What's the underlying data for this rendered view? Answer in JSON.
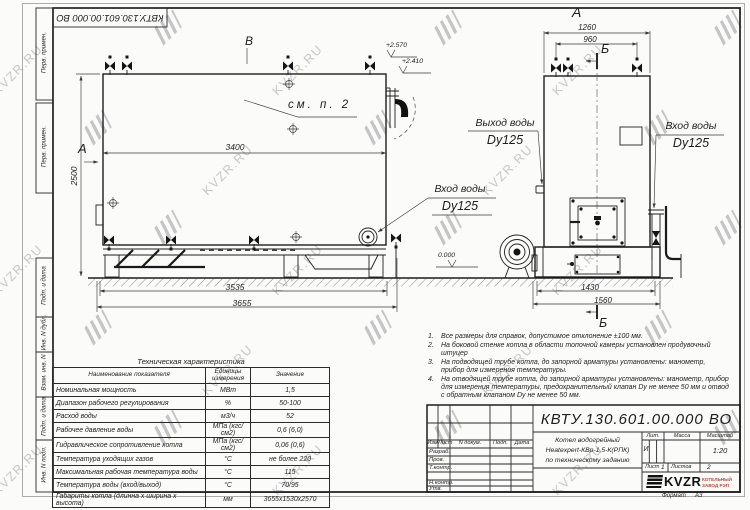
{
  "watermark": {
    "text": "KVZR.RU"
  },
  "doc_number": "КВТУ.130.601.00.000  ВО",
  "margin_fields": [
    "Перв. примен.",
    "Перв. примен.",
    "Подп. и дата",
    "Инв. N дубл.",
    "Взам. инв. N",
    "Подп. и дата",
    "Инв. N подл."
  ],
  "main_view": {
    "letter_a": "А",
    "letter_v": "В",
    "see_note": "см. п. 2",
    "dim_3400": "3400",
    "dim_2500": "2500",
    "dim_3535": "3535",
    "dim_3655": "3655",
    "elev_top": "+2.570",
    "elev_mid": "+2.410",
    "elev_zero": "0.000",
    "inlet_label": "Вход воды",
    "inlet_dn": "Dy125"
  },
  "side_view": {
    "letter_a": "А",
    "letter_b_top": "Б",
    "letter_b_bottom": "Б",
    "dim_1260": "1260",
    "dim_960": "960",
    "dim_1430": "1430",
    "dim_1560": "1560",
    "outlet_label": "Выход воды",
    "outlet_dn": "Dy125",
    "inlet_label": "Вход воды",
    "inlet_dn": "Dy125"
  },
  "notes": [
    {
      "num": "1.",
      "text": "Все размеры для справок, допустимое отклонение ±100 мм."
    },
    {
      "num": "2.",
      "text": "На боковой стенке котла в области топочной камеры установлен продувочный штуцер"
    },
    {
      "num": "3.",
      "text": "На  подводящей трубе котла, до запорной арматуры установлены: манометр, прибор для измерения температуры."
    },
    {
      "num": "4.",
      "text": "На отводящей трубе котла, до запорной арматуры установлены: манометр, прибор для измерения температуры, предохранительный клапан Dу не менее 50 мм и отвод с обратным клапаном Dу не менее 50 мм."
    }
  ],
  "tech_table": {
    "title": "Техническая характеристика",
    "headers": [
      "Наименование показателя",
      "Единицы измерения",
      "Значение"
    ],
    "rows": [
      [
        "Номинальная мощность",
        "МВт",
        "1,5"
      ],
      [
        "Диапазон рабочего регулирования",
        "%",
        "50-100"
      ],
      [
        "Расход воды",
        "м3/ч",
        "52"
      ],
      [
        "Рабочее давление воды",
        "МПа (кгс/см2)",
        "0,6 (6,0)"
      ],
      [
        "Гидравлическое сопротивление котла",
        "МПа (кгс/см2)",
        "0,06 (0,6)"
      ],
      [
        "Температура уходящих газов",
        "°С",
        "не более 220"
      ],
      [
        "Максимальная рабочая температура воды",
        "°С",
        "115"
      ],
      [
        "Температура воды (вход/выход)",
        "°С",
        "70/95"
      ],
      [
        "Габариты котла (длинна х ширина х высота)",
        "мм",
        "3655х1530х2570"
      ]
    ]
  },
  "title_block": {
    "designation": "КВТУ.130.601.00.000  ВО",
    "col_izm": "Изм",
    "col_list": "Лист",
    "col_doc": "N докум.",
    "col_podp": "Подп.",
    "col_data": "Дата",
    "row_razrab": "Разраб.",
    "row_prov": "Пров.",
    "row_tkontr": "Т.контр.",
    "row_nkontr": "Н.контр.",
    "row_utv": "Утв.",
    "name_line1": "Котел водогрейный",
    "name_line2": "Heatexpert-КВр-1,5-К(РПК)",
    "name_line3": "по техническому заданию",
    "lit_header": "Лит.",
    "mass_header": "Масса",
    "scale_header": "Масштаб",
    "lit_value": "И",
    "scale_value": "1:20",
    "sheet_label": "Лист",
    "sheet_value": "1",
    "sheets_label": "Листов",
    "sheets_value": "2",
    "brand": "KVZR",
    "brand_sub1": "КОТЕЛЬНЫЙ",
    "brand_sub2": "ЗАВОД РЭП",
    "format_label": "Формат",
    "format_value": "А3"
  }
}
